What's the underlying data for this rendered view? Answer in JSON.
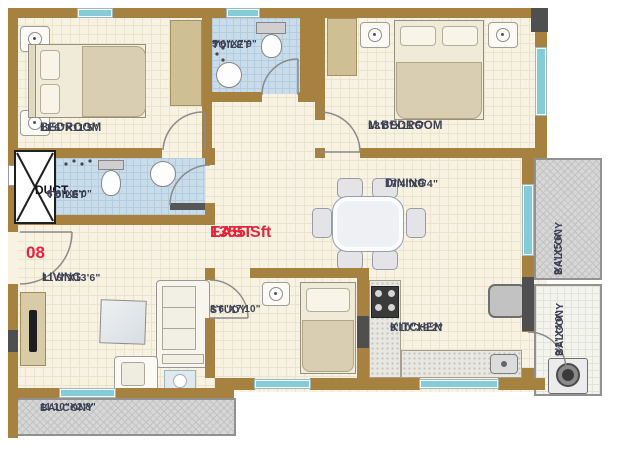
{
  "plan": {
    "unit_number": "08",
    "area": "1355 Sft",
    "facing": "EAST",
    "rooms": {
      "bedroom": {
        "name": "BEDROOM",
        "dims": "11'6\"X11'5\""
      },
      "toilet_top": {
        "name": "TOILET",
        "dims": "5'6\"X7'9\""
      },
      "master_bedroom": {
        "name": "M.BEDROOM",
        "dims": "13'0\"X11'5\""
      },
      "duct": {
        "name": "DUCT"
      },
      "toilet_left": {
        "name": "TOILET",
        "dims": "8'6\"X5'0\""
      },
      "dining": {
        "name": "DINING",
        "dims": "17'4\"X9'4\""
      },
      "living": {
        "name": "LIVING",
        "dims": "11'6\"X13'6\""
      },
      "study": {
        "name": "STUDY",
        "dims": "8'6\"X7'10\""
      },
      "kitchen": {
        "name": "KITCHEN",
        "dims": "9'10\"X9'2\""
      },
      "balcony_east_top": {
        "name": "BALCONY",
        "dims": "9'4\"X5'6\""
      },
      "balcony_east_bottom": {
        "name": "BALCONY",
        "dims": "9'2\"X4'0\""
      },
      "balcony_bottom": {
        "name": "BALCONY",
        "dims": "11'10\"X2'8\""
      }
    },
    "colors": {
      "wall": "#a6813f",
      "floor": "#f7f2e1",
      "toilet_floor": "#c9dcea",
      "balcony_hatch": "#d7d7d7",
      "window": "#86ccd7",
      "label_text": "#3d4254",
      "accent_red": "#e6233b",
      "column_dark": "#4f4f4f"
    }
  }
}
